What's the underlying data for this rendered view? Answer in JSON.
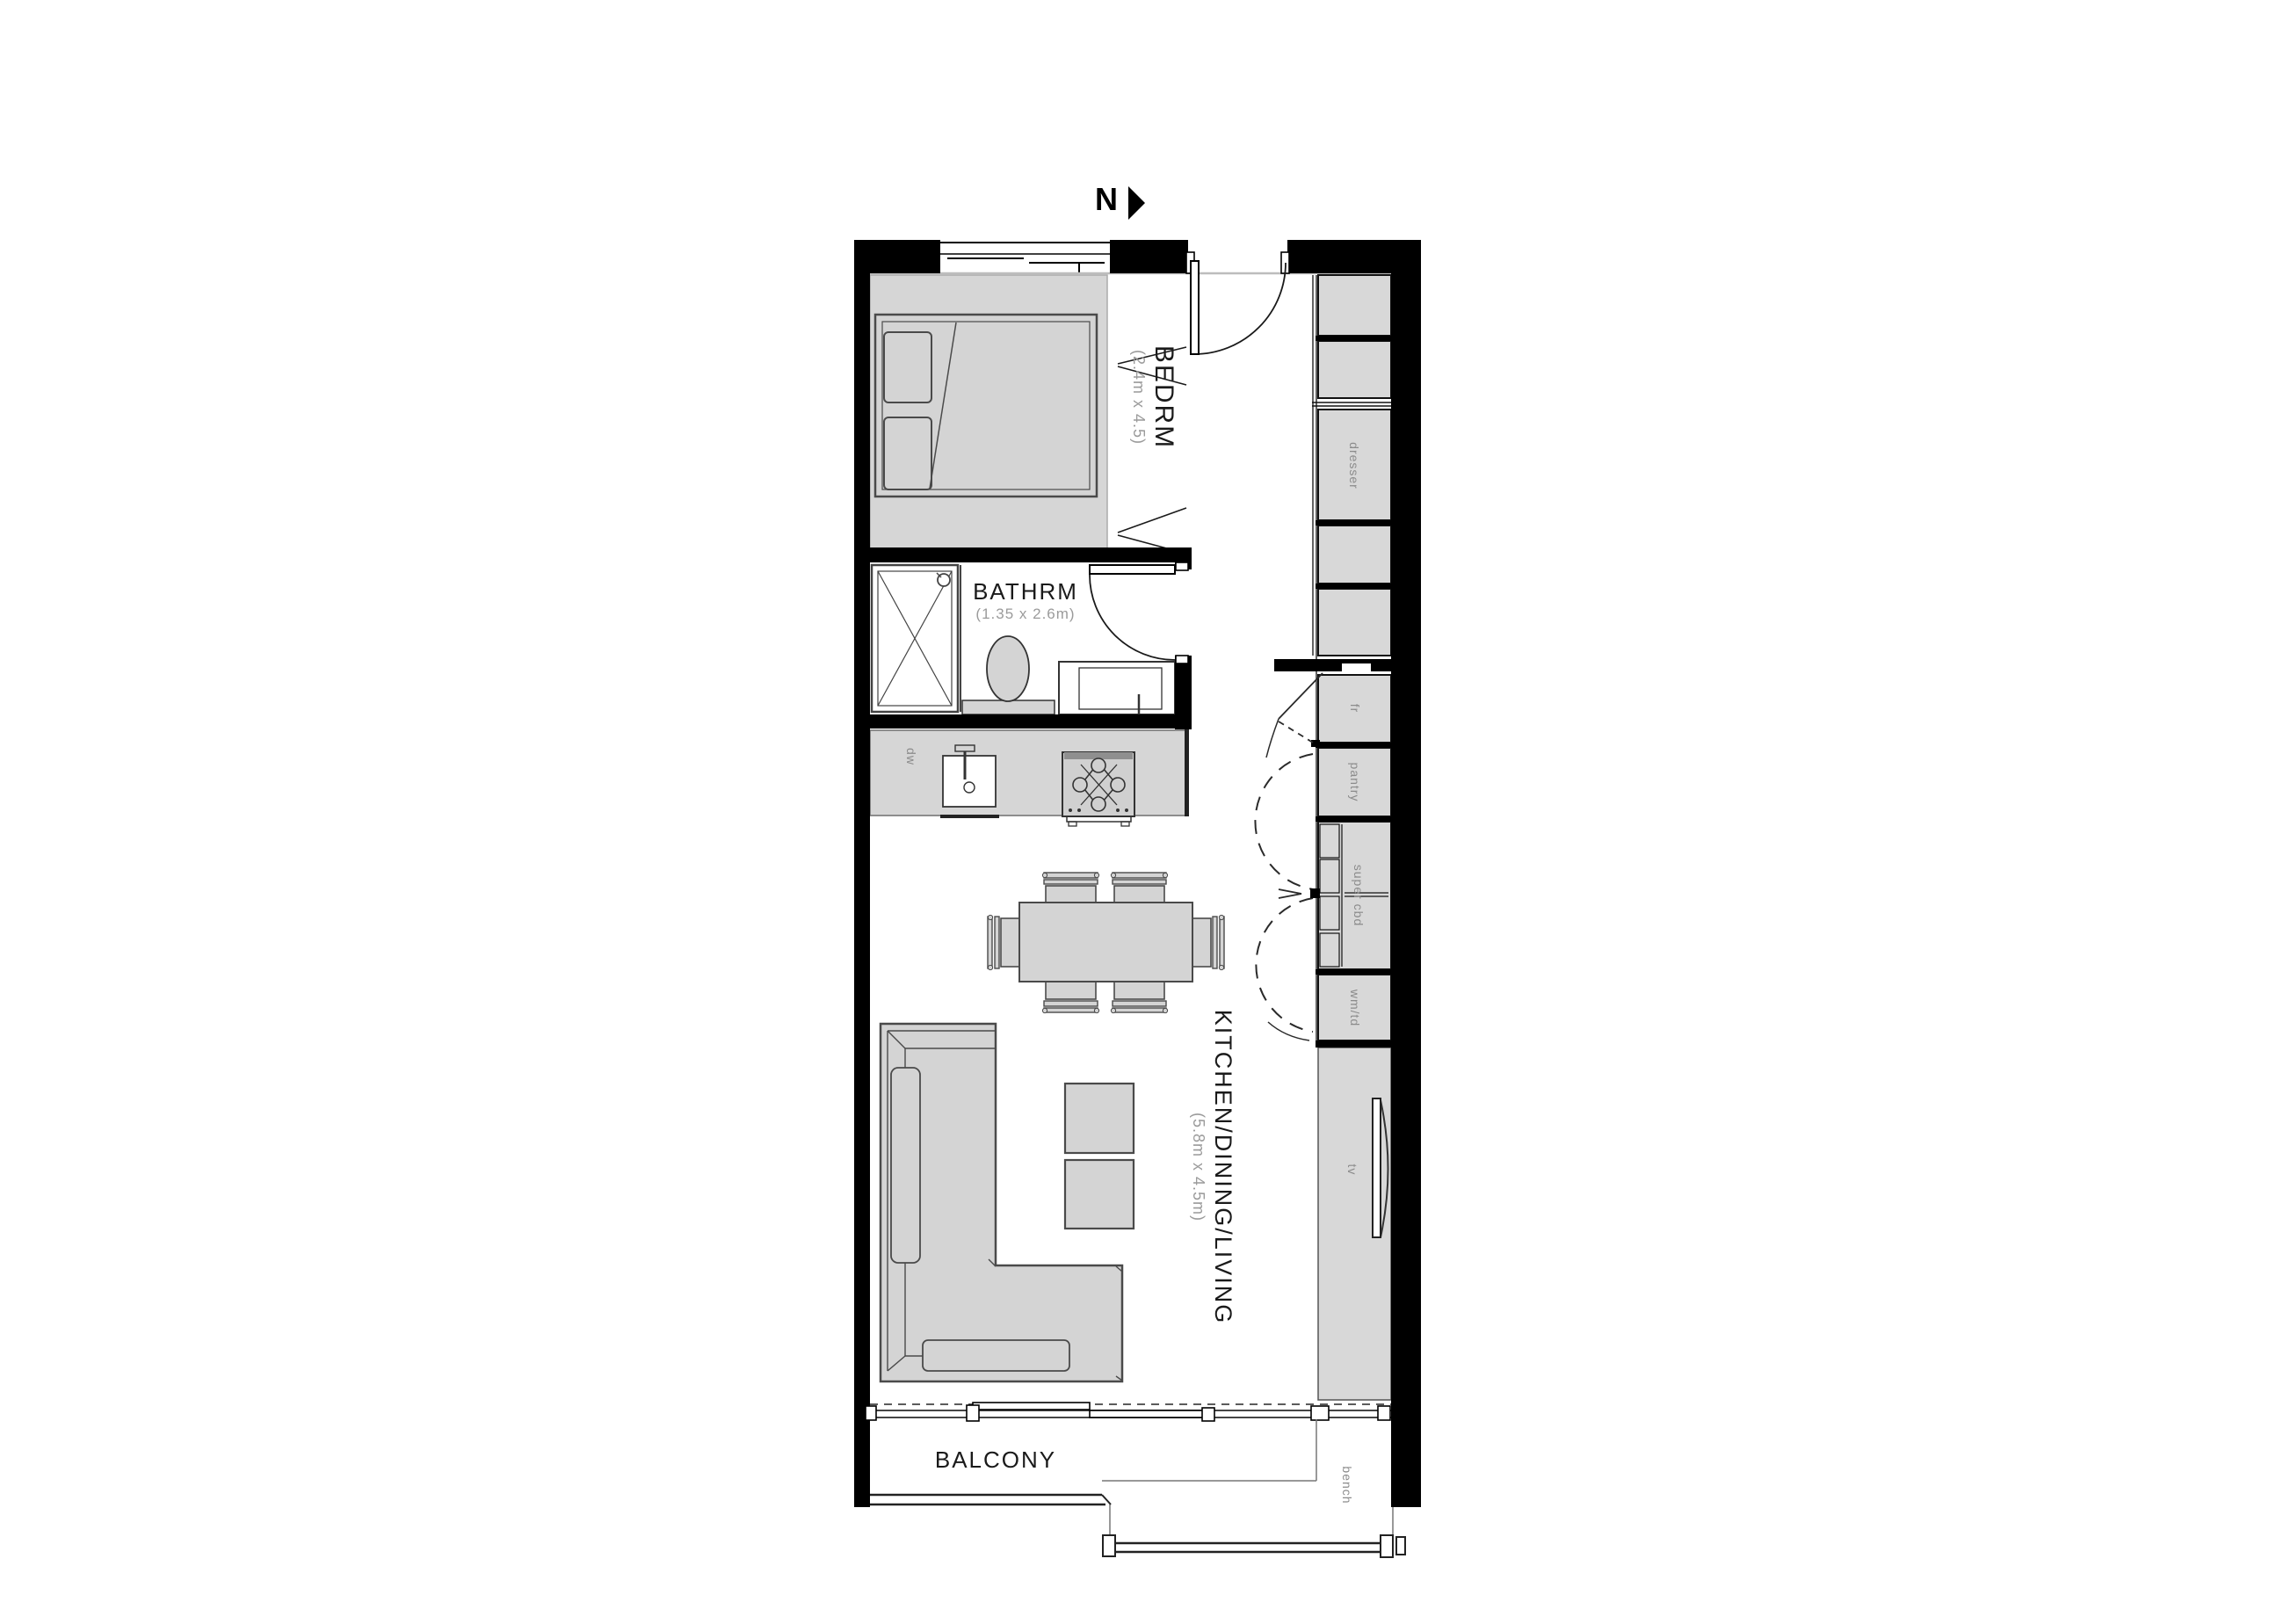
{
  "plan": {
    "type": "apartment-floor-plan",
    "north_label": "N",
    "rooms": {
      "bedroom": {
        "name": "BEDRM",
        "dimensions": "(2.4m x 4.5)"
      },
      "bathroom": {
        "name": "BATHRM",
        "dimensions": "(1.35 x 2.6m)"
      },
      "living": {
        "name": "KITCHEN/DINING/LIVING",
        "dimensions": "(5.8m x 4.5m)"
      },
      "balcony": {
        "name": "BALCONY"
      }
    },
    "fixtures": {
      "dresser": "dresser",
      "fridge": "fr",
      "pantry": "pantry",
      "super_cupboard": "super cbd",
      "washer_dryer": "wm/td",
      "tv": "tv",
      "bench": "bench",
      "dishwasher": "dw"
    },
    "colors": {
      "wall": "#000000",
      "furniture_fill": "#d4d4d4",
      "furniture_stroke": "#4a4a4a",
      "cabinet_fill": "#d8d8d8",
      "dim_text": "#9b9b9b",
      "fixture_text": "#8b8b8b",
      "bulkhead_line": "#bdbdbd",
      "background": "#ffffff"
    }
  }
}
